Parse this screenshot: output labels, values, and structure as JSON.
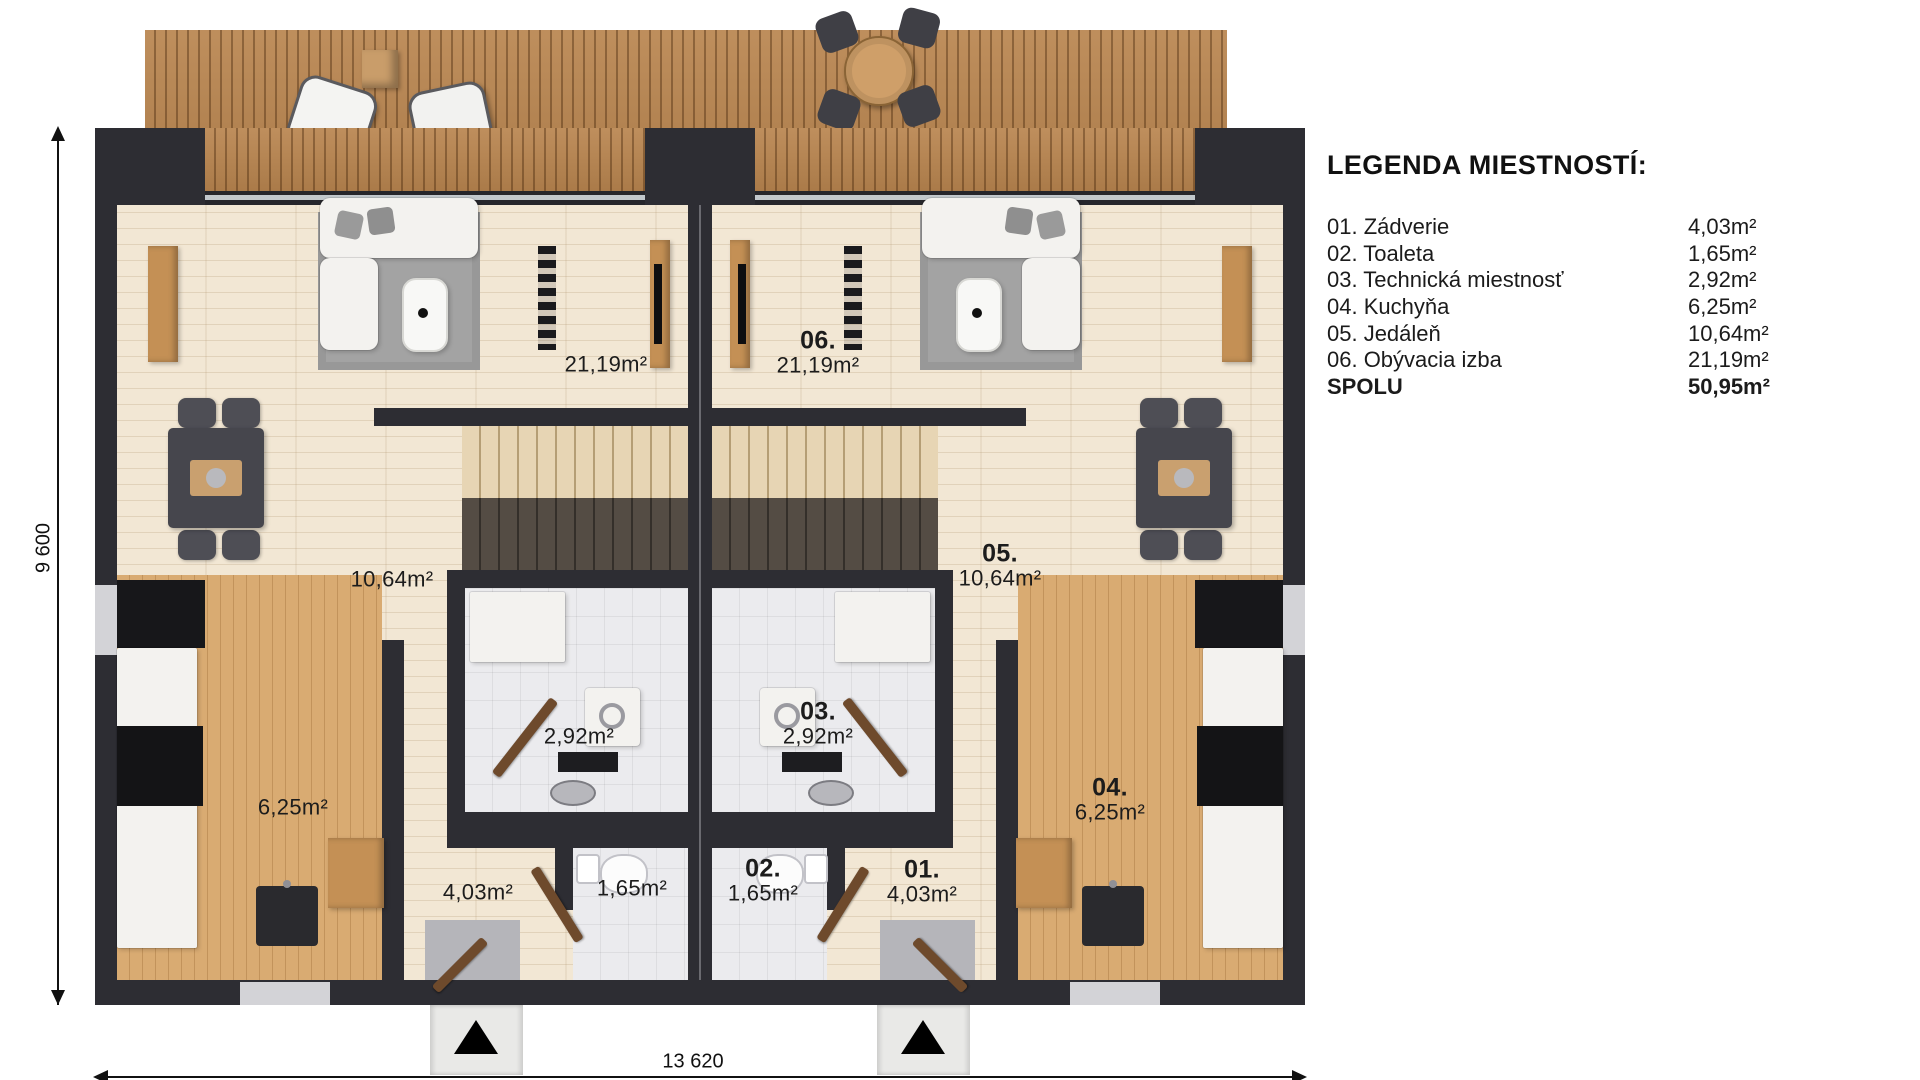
{
  "legend": {
    "title": "LEGENDA MIESTNOSTÍ:",
    "rows": [
      {
        "label": "01. Zádverie",
        "value": "4,03m²"
      },
      {
        "label": "02. Toaleta",
        "value": "1,65m²"
      },
      {
        "label": "03. Technická miestnosť",
        "value": "2,92m²"
      },
      {
        "label": "04. Kuchyňa",
        "value": "6,25m²"
      },
      {
        "label": "05. Jedáleň",
        "value": "10,64m²"
      },
      {
        "label": "06. Obývacia izba",
        "value": "21,19m²"
      },
      {
        "label": "SPOLU",
        "value": "50,95m²"
      }
    ]
  },
  "plan": {
    "dims": {
      "width": "13 620",
      "height": "9 600"
    },
    "left": {
      "living": "21,19m²",
      "dining": "10,64m²",
      "tech": "2,92m²",
      "kitchen": "6,25m²",
      "hall": "4,03m²",
      "toilet": "1,65m²"
    },
    "right": {
      "living": {
        "num": "06.",
        "area": "21,19m²"
      },
      "dining": {
        "num": "05.",
        "area": "10,64m²"
      },
      "tech": {
        "num": "03.",
        "area": "2,92m²"
      },
      "kitchen": {
        "num": "04.",
        "area": "6,25m²"
      },
      "toilet": {
        "num": "02.",
        "area": "1,65m²"
      },
      "hall": {
        "num": "01.",
        "area": "4,03m²"
      }
    }
  },
  "colors": {
    "wall": "#2d2d33",
    "deck": "#b9854f",
    "floor": "#f2e7d4",
    "text": "#1b1b1b"
  }
}
